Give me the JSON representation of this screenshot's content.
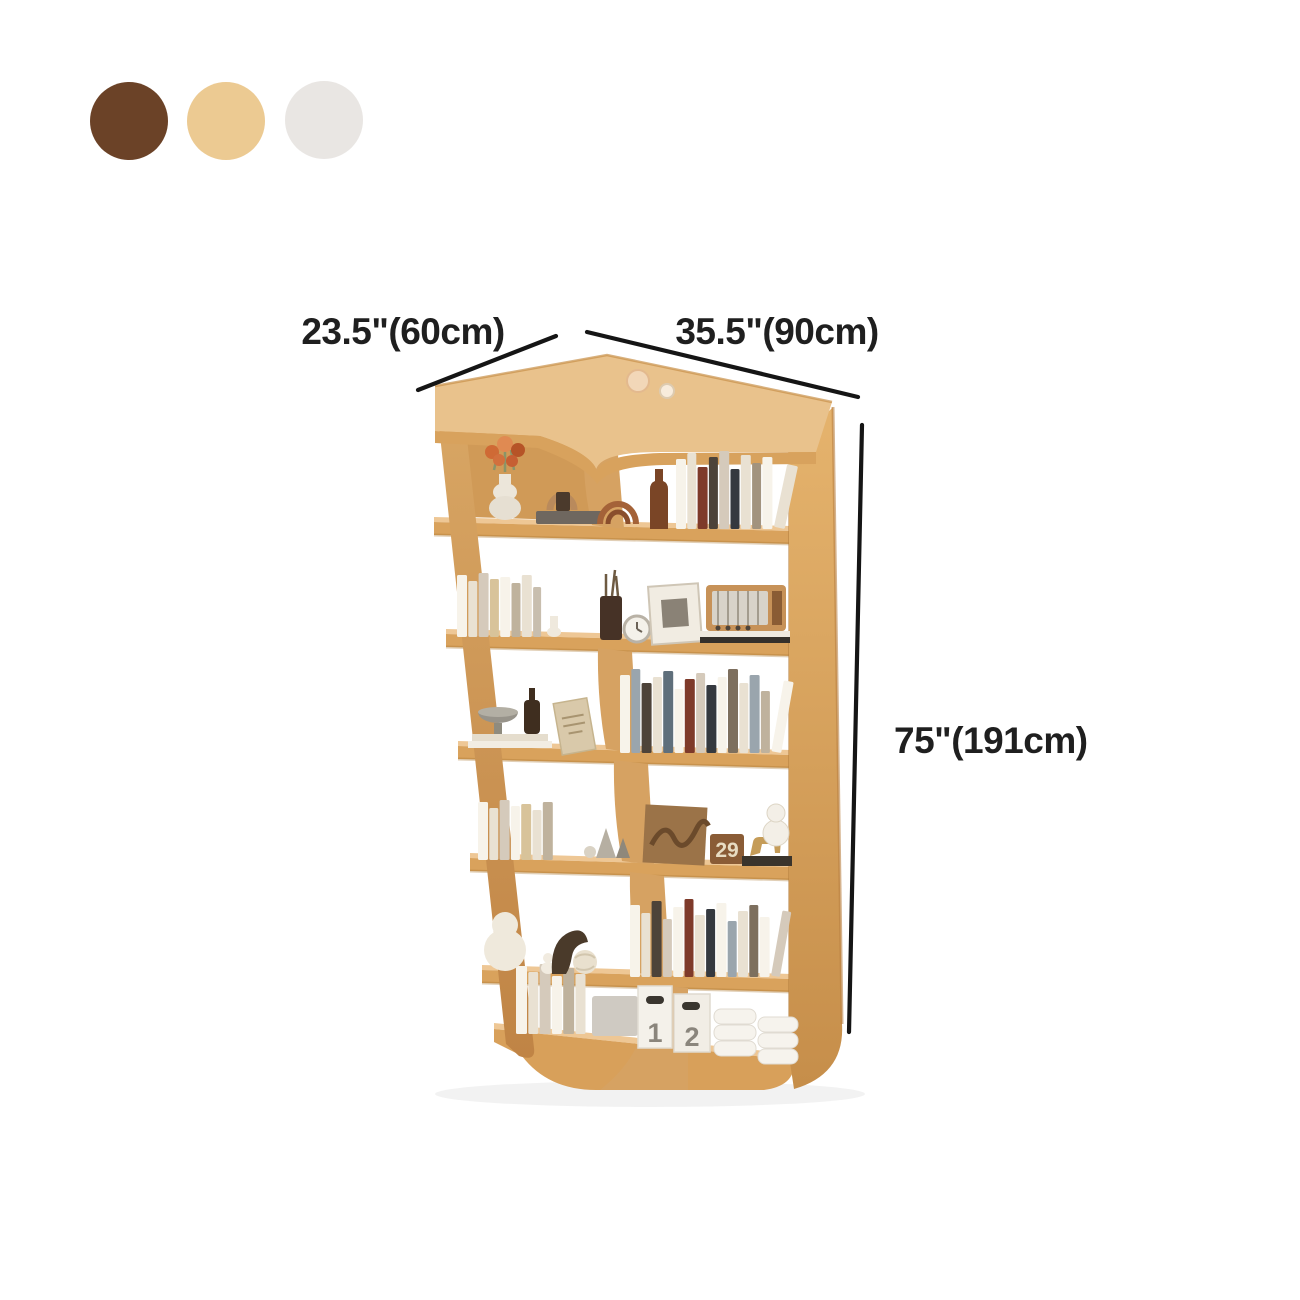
{
  "scene": {
    "background": "#ffffff",
    "type": "furniture product dimension image"
  },
  "color_swatches": [
    {
      "name": "dark-brown",
      "hex": "#6b4227"
    },
    {
      "name": "natural-oak",
      "hex": "#ecca92"
    },
    {
      "name": "ivory-white",
      "hex": "#e9e6e3"
    }
  ],
  "dimension_labels": {
    "left_depth": "23.5\"(60cm)",
    "right_width": "35.5\"(90cm)",
    "height": "75\"(191cm)"
  },
  "product": {
    "name": "6-tier L-shaped corner bookshelf",
    "wood_colors": {
      "top": "#eec795",
      "front": "#d9a25c",
      "side": "#c08445",
      "shadow": "#a9752f"
    },
    "calendar_block_text": "29",
    "file_box_labels": [
      "1",
      "2"
    ],
    "tiers": [
      {
        "index": 1,
        "left_items": [
          "flower-vase",
          "arch-handbag",
          "wood-arch-ornament"
        ],
        "right_items": [
          "amber-bottle",
          "book-row"
        ],
        "top_items": [
          "cream-sphere",
          "glass-sphere"
        ]
      },
      {
        "index": 2,
        "left_items": [
          "book-row",
          "chess-ornament"
        ],
        "right_items": [
          "pen-cup",
          "alarm-clock",
          "photo-frame",
          "vintage-radio",
          "magazine-stack"
        ]
      },
      {
        "index": 3,
        "left_items": [
          "book-stack",
          "pedestal-bowl",
          "diffuser-bottle"
        ],
        "right_items": [
          "leaning-card",
          "book-row"
        ]
      },
      {
        "index": 4,
        "left_items": [
          "book-row",
          "cone-ornaments"
        ],
        "right_items": [
          "wood-art-relief",
          "calendar-block",
          "dog-figurine",
          "book-stack",
          "gourd-lamp"
        ]
      },
      {
        "index": 5,
        "left_items": [
          "gourd-vase",
          "mini-figurine",
          "leaf-ornament",
          "knot-ball"
        ],
        "right_items": [
          "book-row"
        ]
      },
      {
        "index": 6,
        "left_items": [
          "book-row",
          "storage-bin"
        ],
        "right_items": [
          "file-box-1",
          "file-box-2",
          "tray-stack-a",
          "tray-stack-b"
        ]
      }
    ]
  },
  "bookshelf": {
    "book_palette": [
      "#f7f3ea",
      "#e9e1d2",
      "#d5cabb",
      "#bfb29d",
      "#a2937e",
      "#7d6f5e",
      "#4d4339",
      "#7e3a2a",
      "#96502f",
      "#9aa5ad",
      "#5f6f7b",
      "#d8c39a",
      "#35393f",
      "#c8beae"
    ],
    "book_rows": [
      {
        "name": "tier1-right-books",
        "x": 676,
        "y": 529,
        "books": [
          [
            10,
            70,
            0
          ],
          [
            9,
            76,
            1
          ],
          [
            10,
            62,
            7
          ],
          [
            9,
            72,
            6
          ],
          [
            10,
            78,
            2
          ],
          [
            9,
            60,
            12
          ],
          [
            10,
            74,
            1
          ],
          [
            9,
            66,
            4
          ],
          [
            10,
            72,
            0
          ],
          [
            11,
            64,
            1,
            12
          ]
        ]
      },
      {
        "name": "tier2-left-books",
        "x": 457,
        "y": 637,
        "books": [
          [
            10,
            62,
            0
          ],
          [
            9,
            56,
            1
          ],
          [
            10,
            64,
            2
          ],
          [
            9,
            58,
            11
          ],
          [
            10,
            60,
            0
          ],
          [
            9,
            54,
            3
          ],
          [
            10,
            62,
            1
          ],
          [
            8,
            50,
            13
          ]
        ]
      },
      {
        "name": "tier3-right-books",
        "x": 620,
        "y": 753,
        "books": [
          [
            10,
            78,
            0
          ],
          [
            9,
            84,
            9
          ],
          [
            10,
            70,
            6
          ],
          [
            9,
            76,
            1
          ],
          [
            10,
            82,
            10
          ],
          [
            9,
            64,
            0
          ],
          [
            10,
            74,
            7
          ],
          [
            9,
            80,
            2
          ],
          [
            10,
            68,
            12
          ],
          [
            9,
            76,
            0
          ],
          [
            10,
            84,
            5
          ],
          [
            9,
            70,
            1
          ],
          [
            10,
            78,
            9
          ],
          [
            9,
            62,
            3
          ],
          [
            10,
            72,
            0,
            10
          ]
        ]
      },
      {
        "name": "tier4-left-books",
        "x": 478,
        "y": 860,
        "books": [
          [
            10,
            58,
            0
          ],
          [
            9,
            52,
            1
          ],
          [
            10,
            60,
            2
          ],
          [
            9,
            54,
            0
          ],
          [
            10,
            56,
            11
          ],
          [
            9,
            50,
            1
          ],
          [
            10,
            58,
            3
          ]
        ]
      },
      {
        "name": "tier5-right-books",
        "x": 630,
        "y": 977,
        "books": [
          [
            10,
            72,
            0
          ],
          [
            9,
            64,
            1
          ],
          [
            10,
            76,
            6
          ],
          [
            9,
            58,
            2
          ],
          [
            10,
            70,
            0
          ],
          [
            9,
            78,
            7
          ],
          [
            10,
            62,
            1
          ],
          [
            9,
            68,
            12
          ],
          [
            10,
            74,
            0
          ],
          [
            9,
            56,
            9
          ],
          [
            10,
            66,
            1
          ],
          [
            9,
            72,
            5
          ],
          [
            10,
            60,
            0
          ],
          [
            9,
            66,
            2,
            10
          ]
        ]
      },
      {
        "name": "tier6-left-books",
        "x": 516,
        "y": 1034,
        "books": [
          [
            11,
            68,
            0
          ],
          [
            10,
            62,
            1
          ],
          [
            11,
            70,
            2
          ],
          [
            10,
            58,
            0
          ],
          [
            11,
            66,
            3
          ],
          [
            10,
            60,
            1
          ]
        ]
      }
    ]
  }
}
